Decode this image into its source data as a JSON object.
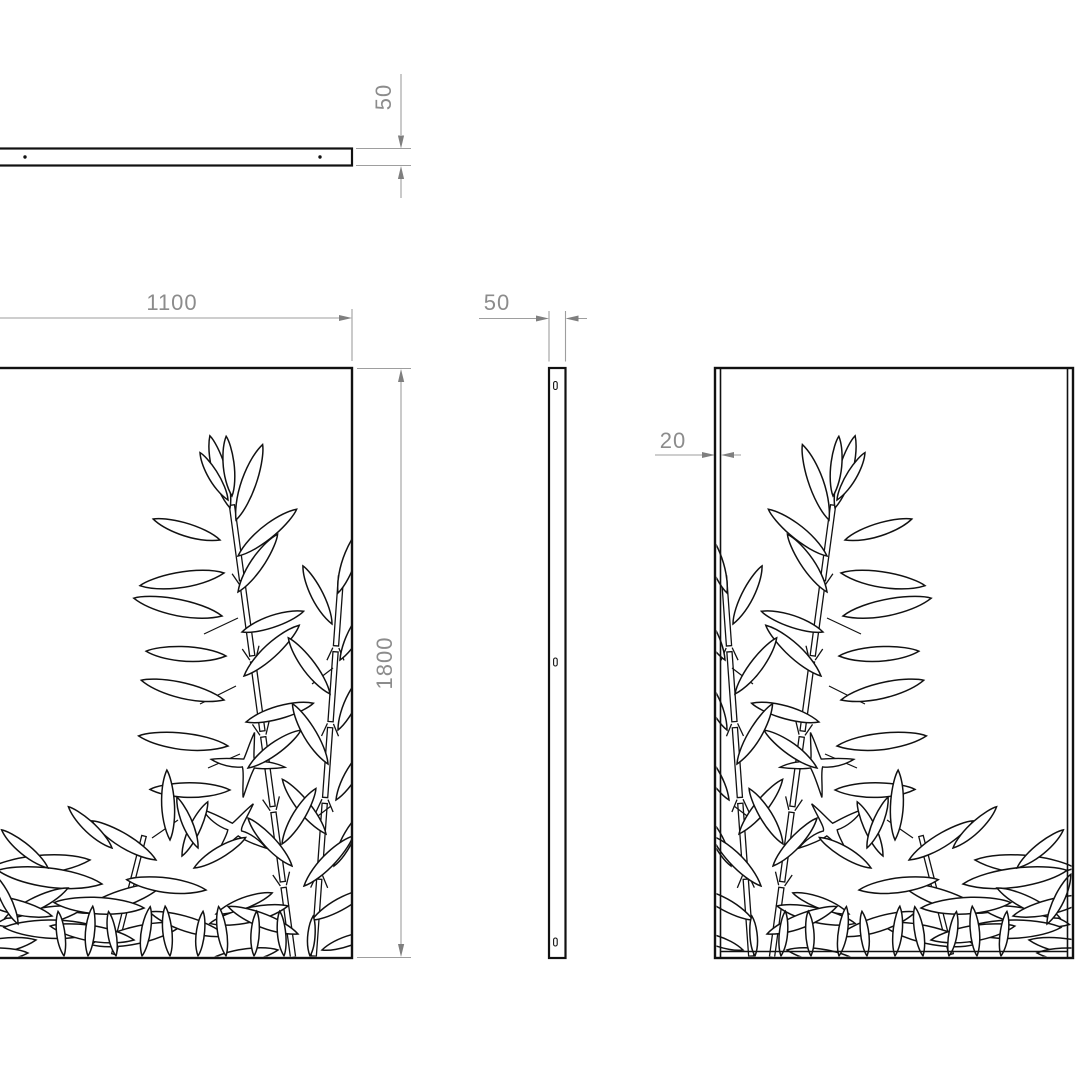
{
  "drawing": {
    "background": "#ffffff",
    "edge_color": "#111111",
    "dim_line_color": "#9e9e9e",
    "dim_text_color": "#8c8c8c",
    "dimensions": {
      "panel_thickness": "50",
      "panel_width": "1100",
      "panel_height": "1800",
      "side_depth": "50",
      "flange_depth": "20"
    }
  }
}
